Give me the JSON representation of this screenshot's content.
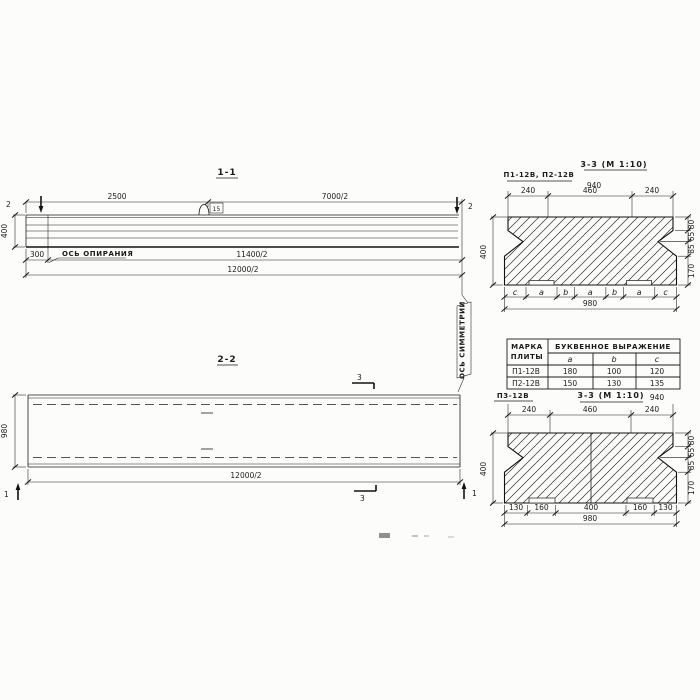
{
  "section_1_1": {
    "title": "1-1",
    "dim_top_left": "2500",
    "dim_top_right": "7000/2",
    "cut_left": "2",
    "cut_right": "2",
    "dim_height": "400",
    "dim_offset": "300",
    "bearing_axis_label": "ОСЬ ОПИРАНИЯ",
    "dim_bearing_span": "11400/2",
    "dim_total": "12000/2",
    "loop_tag": "15"
  },
  "section_2_2": {
    "title": "2-2",
    "dim_width": "980",
    "dim_total": "12000/2",
    "cut_3_top": "3",
    "cut_3_bottom": "3",
    "cut_1_left": "1",
    "cut_1_right": "1"
  },
  "symmetry_axis_label": "ОСЬ СИММЕТРИИ",
  "section_3_3_top": {
    "variant_label": "П1-12В, П2-12В",
    "title": "3-3 (М 1:10)",
    "dim_940": "940",
    "dim_240_left": "240",
    "dim_460": "460",
    "dim_240_right": "240",
    "dim_height": "400",
    "right_dims": [
      "80",
      "65",
      "85",
      "170"
    ],
    "letter_dims": [
      "c",
      "a",
      "b",
      "a",
      "b",
      "a",
      "c"
    ],
    "dim_980": "980"
  },
  "table": {
    "col_mark_line1": "МАРКА",
    "col_mark_line2": "ПЛИТЫ",
    "header_expression": "БУКВЕННОЕ  ВЫРАЖЕНИЕ",
    "cols": [
      "a",
      "b",
      "c"
    ],
    "rows": [
      {
        "mark": "П1-12В",
        "a": "180",
        "b": "100",
        "c": "120"
      },
      {
        "mark": "П2-12В",
        "a": "150",
        "b": "130",
        "c": "135"
      }
    ]
  },
  "section_3_3_bottom": {
    "variant_label": "П3-12В",
    "title": "3-3 (М 1:10)",
    "dim_940": "940",
    "dim_240_left": "240",
    "dim_460": "460",
    "dim_240_right": "240",
    "dim_height": "400",
    "right_dims": [
      "80",
      "65",
      "85",
      "170"
    ],
    "bottom_dims": [
      "130",
      "160",
      "400",
      "160",
      "130"
    ],
    "dim_980": "980"
  }
}
